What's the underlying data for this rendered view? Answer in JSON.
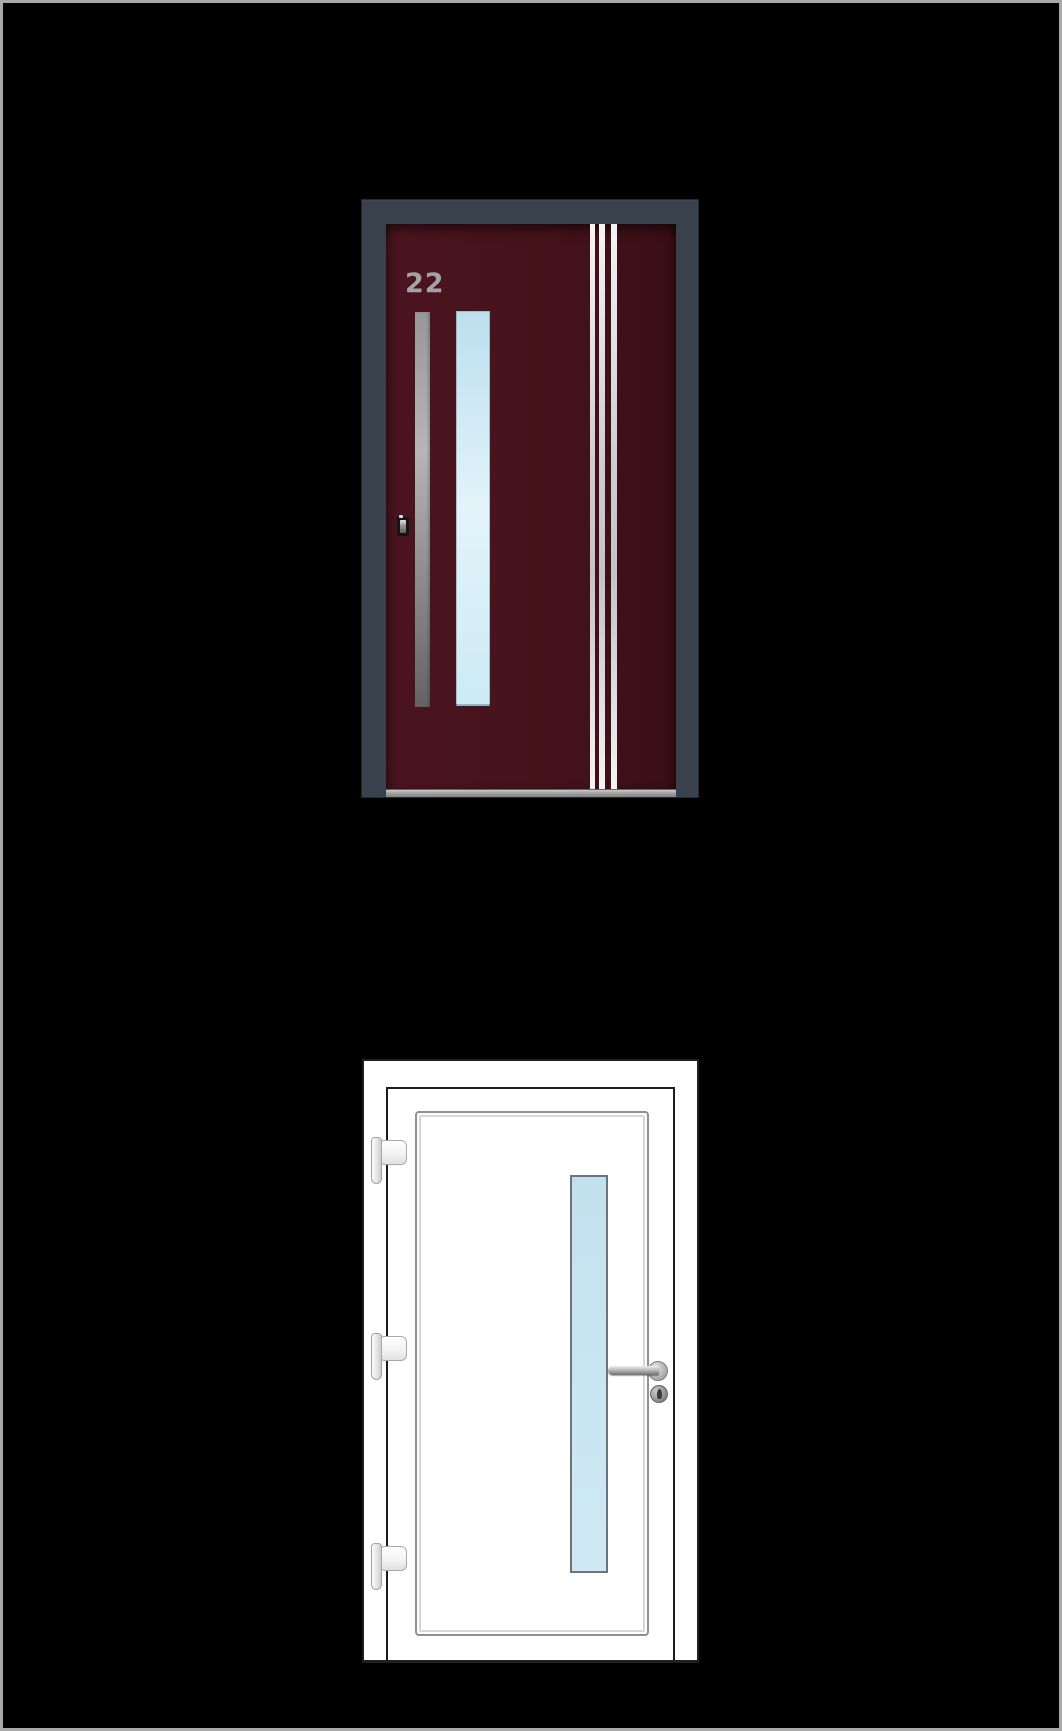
{
  "canvas": {
    "background": "#000000",
    "border_color": "#a8a8a8"
  },
  "doors": {
    "top": {
      "house_number": "22",
      "stripe_count": 3,
      "style": {
        "frame_color": "#39414c",
        "panel_color_light": "#4b1520",
        "panel_color_mid": "#45121a",
        "panel_color_dark": "#3a0e16",
        "number_color": "#a2a2a7",
        "stripe_highlight": "#f4f4f5",
        "stripe_mid": "#cbcbd0",
        "glass_top": "#bcdfee",
        "glass_mid": "#e3f3fa",
        "glass_bottom": "#cdeaf5",
        "handle_top": "#979797",
        "handle_highlight": "#b6b6b6",
        "handle_bottom": "#636363",
        "threshold_color": "#9a9a9a"
      }
    },
    "bottom": {
      "hinge_count": 3,
      "style": {
        "frame_color": "#ffffff",
        "outline_color": "#1f1f1f",
        "groove_outer": "#919191",
        "groove_inner": "#d7d7d7",
        "glass_fill": "#c2e1ee",
        "glass_border": "#6d7376",
        "hardware_light": "#b5b5b5",
        "hardware_dark": "#8a8a8a"
      }
    }
  }
}
